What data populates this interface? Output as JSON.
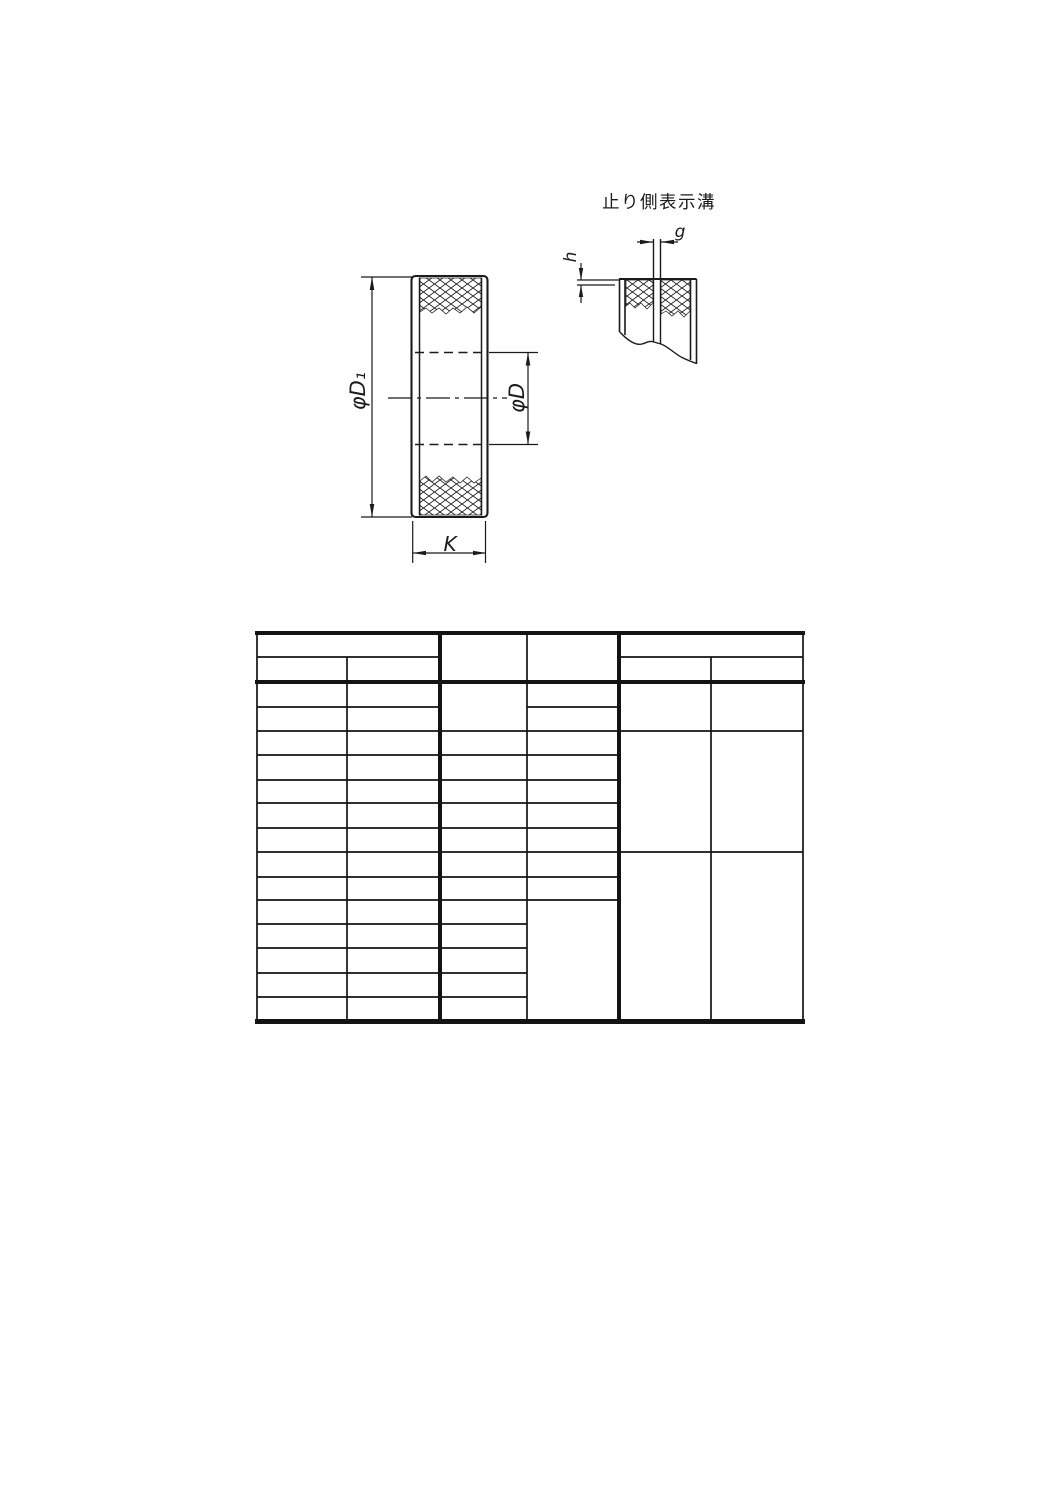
{
  "page": {
    "background": "#ffffff",
    "ink_color": "#1b1b1b"
  },
  "figure": {
    "caption": "止り側表示溝",
    "dimension_labels": {
      "outer_diameter": "φD₁",
      "bore_diameter": "φD",
      "gauge_width": "K",
      "groove_width": "g",
      "groove_depth": "h"
    }
  },
  "table": {
    "columns": 6,
    "header_rows": 2,
    "body_rows": 14,
    "all_cells_empty": true
  }
}
